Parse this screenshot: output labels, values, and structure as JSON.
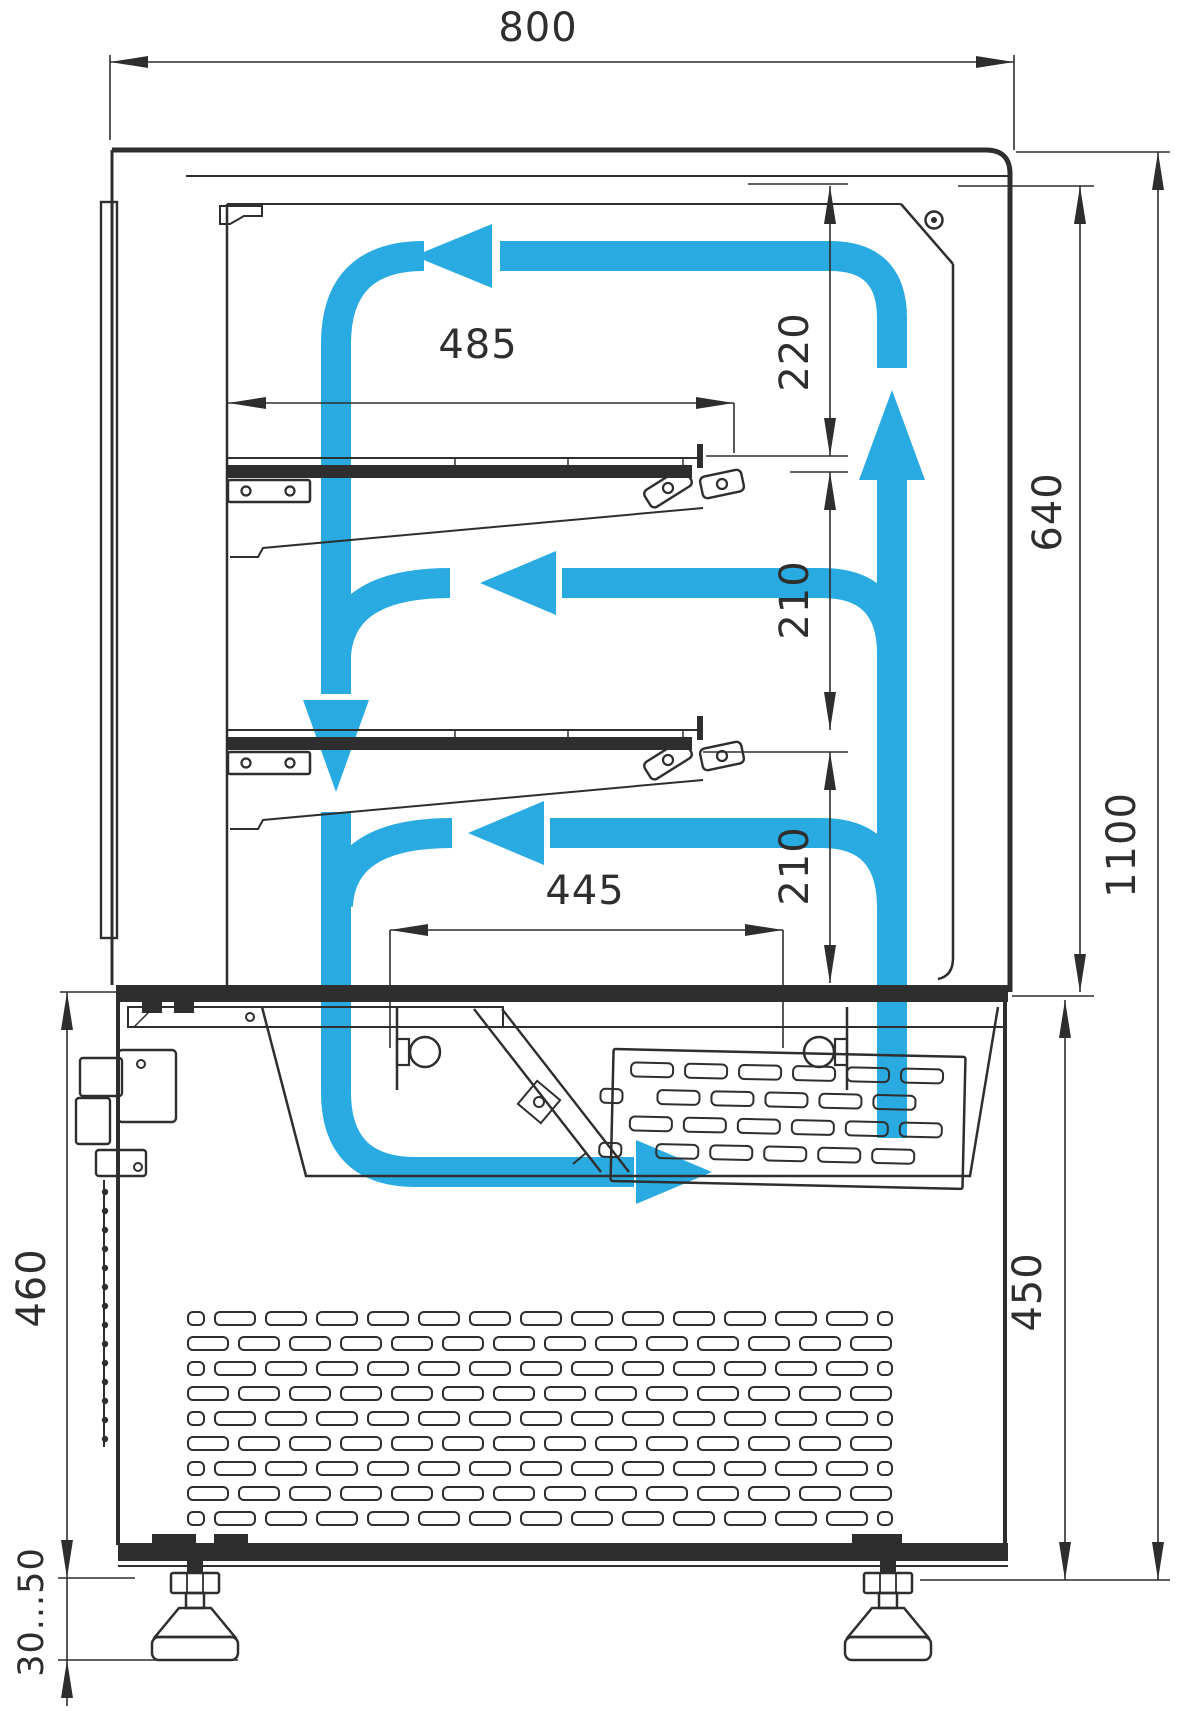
{
  "diagram": {
    "type": "technical-drawing",
    "subject": "refrigerated display case side cross-section with air circulation scheme",
    "accent_color": "#29ABE2",
    "ink_color": "#2E2E2E",
    "units": "mm",
    "dimensions": {
      "overall_width": "800",
      "upper_shelf_length": "485",
      "top_clearance": "220",
      "display_chamber_height": "640",
      "shelf_gap_upper": "210",
      "shelf_gap_lower": "210",
      "bottom_tray_width": "445",
      "overall_height": "1100",
      "base_height_right": "450",
      "base_height_left": "460",
      "foot_adjust_range": "30...50"
    },
    "airflow": {
      "color_name": "blue",
      "arrows": [
        "air-rises-at-back-wall",
        "air-flows-left-along-ceiling",
        "air-falls-at-front",
        "air-blows-left-above-middle-shelf",
        "air-blows-left-above-bottom-deck",
        "air-returns-right-through-bottom-tray"
      ]
    }
  }
}
